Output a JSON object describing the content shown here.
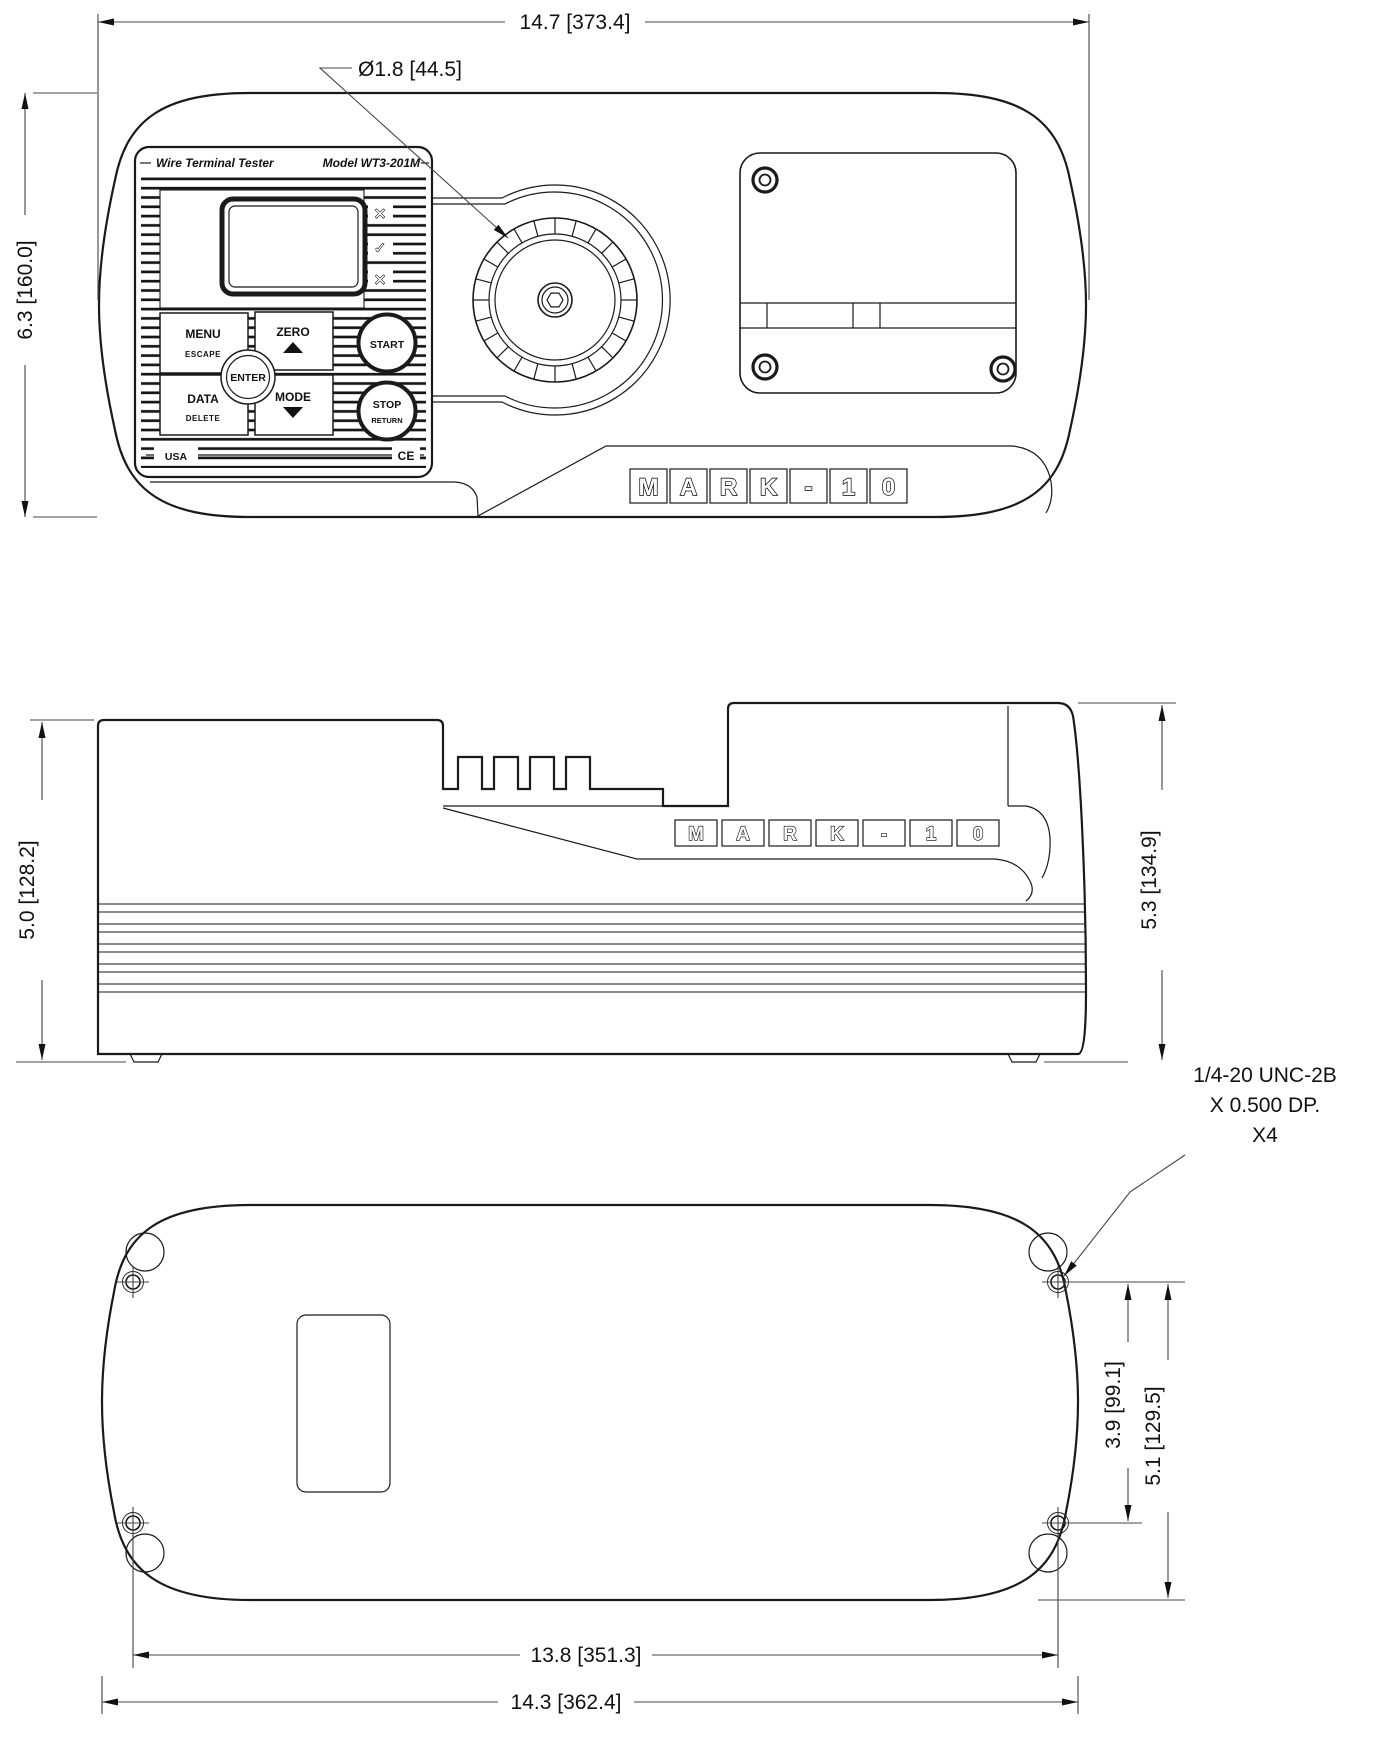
{
  "device": {
    "brand_letters": [
      "M",
      "A",
      "R",
      "K",
      "-",
      "1",
      "0"
    ],
    "panel": {
      "title": "Wire Terminal Tester",
      "model": "Model WT3-201M",
      "indicators": [
        "✕",
        "✓",
        "✕"
      ],
      "buttons": {
        "menu": "MENU",
        "escape": "ESCAPE",
        "zero": "ZERO",
        "enter": "ENTER",
        "data": "DATA",
        "delete": "DELETE",
        "mode": "MODE",
        "start": "START",
        "stop": "STOP",
        "return": "RETURN"
      },
      "origin_label": "USA",
      "ce_label": "CE"
    }
  },
  "dimensions": {
    "overall_width": "14.7 [373.4]",
    "knob_diameter": "Ø1.8 [44.5]",
    "overall_depth": "6.3 [160.0]",
    "height_front": "5.0 [128.2]",
    "height_overall": "5.3 [134.9]",
    "thread_callout_line1": "1/4-20 UNC-2B",
    "thread_callout_line2": "X 0.500 DP.",
    "thread_callout_line3": "X4",
    "hole_spacing_depth": "3.9 [99.1]",
    "hole_to_edge_depth": "5.1 [129.5]",
    "hole_spacing_width": "13.8 [351.3]",
    "base_width": "14.3 [362.4]"
  }
}
